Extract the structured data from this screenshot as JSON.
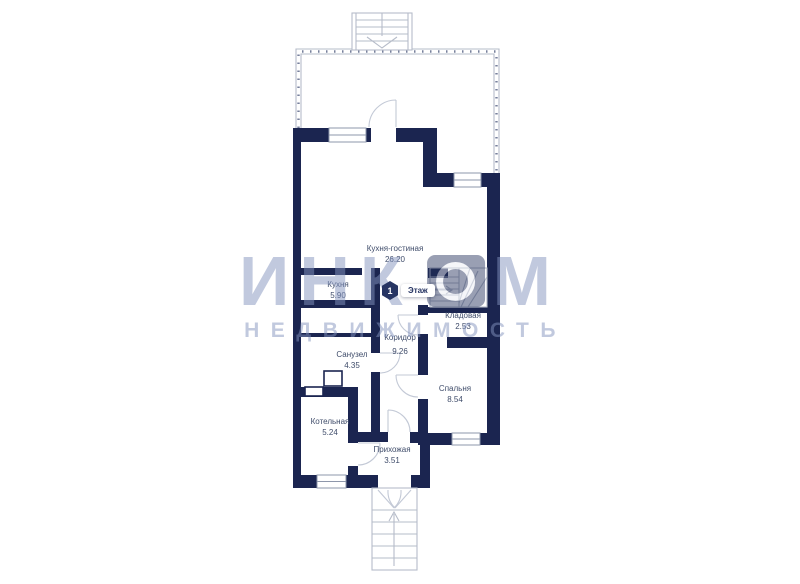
{
  "colors": {
    "wall": "#1B2550",
    "line": "#B6BCC9",
    "frame": "#8E97AB",
    "arc": "#C3C9D6",
    "label": "#3F4C6A",
    "watermark": "#8494BF"
  },
  "floor_badge": {
    "number": "1",
    "label": "Этаж"
  },
  "rooms": [
    {
      "name": "Кухня-гостиная",
      "area": "26.20"
    },
    {
      "name": "Кухня",
      "area": "5.90"
    },
    {
      "name": "Кладовая",
      "area": "2.53"
    },
    {
      "name": "Коридор",
      "area": "9.26"
    },
    {
      "name": "Санузел",
      "area": "4.35"
    },
    {
      "name": "Спальня",
      "area": "8.54"
    },
    {
      "name": "Котельная",
      "area": "5.24"
    },
    {
      "name": "Прихожая",
      "area": "3.51"
    }
  ],
  "watermark": {
    "brand_prefix": "ИНК",
    "brand_logo_letter": "О",
    "brand_suffix": "М",
    "subtitle": "НЕДВИЖИМОСТЬ"
  }
}
